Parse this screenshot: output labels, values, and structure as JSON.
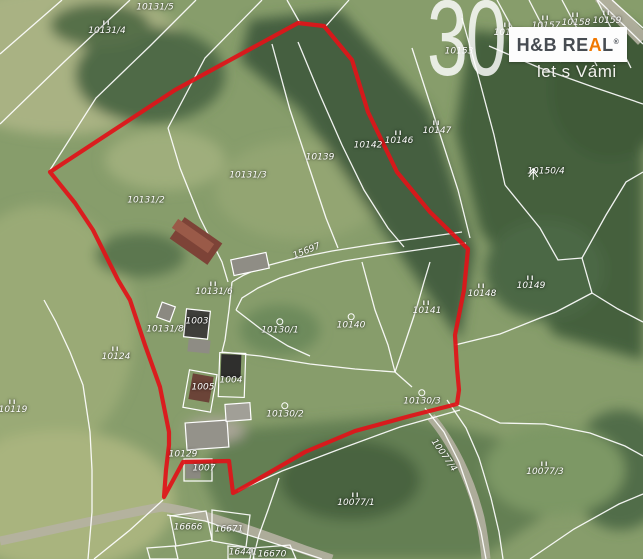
{
  "watermark": {
    "number": "30",
    "slogan": "let s Vámi"
  },
  "logo": {
    "part1": "H&B RE",
    "accent_letter": "A",
    "part2": "L",
    "registered": "®",
    "accent_color": "#f07800",
    "text_color": "#474c52"
  },
  "map": {
    "boundary_color": "#e01319",
    "line_color": "rgba(255,255,255,0.92)",
    "boundary_points": "50,172 175,90 298,23 324,26 352,60 368,112 397,172 430,212 468,249 464,290 455,335 457,368 459,390 457,404 410,416 355,431 305,452 260,478 237,491 233,493 229,461 183,462 164,497 166,470 169,445 169,432 160,387 145,345 130,300 118,280 93,230 75,203",
    "cadastral_lines": [
      "62,0 0,54",
      "130,0 64,62 0,124",
      "196,0 150,46 96,98 50,170",
      "262,0 205,58 168,128",
      "287,0 300,23",
      "326,26 349,0",
      "168,128 180,168 200,218 222,262 228,282",
      "272,44 290,110 310,170 326,218 338,248",
      "298,42 320,95 342,145 364,190 388,228 404,247",
      "412,48 436,122 458,190 470,238",
      "462,18 478,75 494,135 505,185",
      "497,0 527,55",
      "529,0 561,62",
      "562,0 597,66",
      "597,0 631,68",
      "489,46 540,68 596,88 643,104",
      "598,0 643,44",
      "612,0 643,28",
      "505,185 540,228 558,260 582,258",
      "582,258 606,215 626,182 643,172",
      "582,258 592,293",
      "592,293 556,312 540,318 500,334 455,345",
      "592,293 618,309 643,322",
      "460,410 400,427 340,449 282,471 238,491",
      "455,404 478,413 500,423 545,424 590,433 625,446 643,456",
      "425,408 444,432 459,462 472,500 481,532 486,559",
      "447,400 466,428 479,458 491,498 499,532 503,559",
      "530,559 574,529 619,504 643,494",
      "44,300 56,322 70,352 83,385 90,432 92,470 92,512 88,559",
      "163,500 130,530 94,559",
      "167,515 205,521 245,534 292,549 322,559",
      "279,478 268,510 259,535 253,559",
      "462,232 420,238 376,244 332,251 292,259 262,267 244,275 232,282",
      "466,243 424,249 382,255 344,261 310,269 280,278 258,288 242,298 236,310",
      "232,282 229,310 225,340 222,352",
      "222,352 260,356 310,364 355,369 395,372",
      "395,372 406,340 416,310 424,282 430,262",
      "395,372 412,387",
      "236,310 262,330 288,346 310,356",
      "362,262 375,310 388,345 395,372"
    ],
    "parcel_outlines": [
      "170,516 206,511 212,540 176,546",
      "212,510 250,515 246,547 212,541",
      "228,546 252,548 250,559 228,559",
      "252,548 290,545 296,559 254,559",
      "147,548 175,546 178,559 150,559"
    ],
    "buildings": [
      {
        "cx": 196,
        "cy": 241,
        "w": 46,
        "h": 26,
        "rot": 35,
        "fill": "#7d4337",
        "stroke": ""
      },
      {
        "cx": 193,
        "cy": 236,
        "w": 44,
        "h": 11,
        "rot": 35,
        "fill": "#9a5a48",
        "stroke": ""
      },
      {
        "cx": 250,
        "cy": 264,
        "w": 36,
        "h": 16,
        "rot": -12,
        "fill": "#8f8d85",
        "stroke": "#ffffff"
      },
      {
        "cx": 197,
        "cy": 324,
        "w": 24,
        "h": 28,
        "rot": 6,
        "fill": "#3f3f3b",
        "stroke": "#ffffff"
      },
      {
        "cx": 199,
        "cy": 346,
        "w": 22,
        "h": 13,
        "rot": 6,
        "fill": "#8e8c84",
        "stroke": ""
      },
      {
        "cx": 232,
        "cy": 375,
        "w": 26,
        "h": 44,
        "rot": 2,
        "fill": "none",
        "stroke": "#ffffff"
      },
      {
        "cx": 231,
        "cy": 366,
        "w": 20,
        "h": 23,
        "rot": 2,
        "fill": "#2f2f2d",
        "stroke": ""
      },
      {
        "cx": 200,
        "cy": 391,
        "w": 28,
        "h": 38,
        "rot": 10,
        "fill": "none",
        "stroke": "#ffffff"
      },
      {
        "cx": 201,
        "cy": 388,
        "w": 21,
        "h": 26,
        "rot": 10,
        "fill": "#6b4438",
        "stroke": ""
      },
      {
        "cx": 207,
        "cy": 435,
        "w": 42,
        "h": 27,
        "rot": -4,
        "fill": "#94928a",
        "stroke": "#ffffff"
      },
      {
        "cx": 238,
        "cy": 412,
        "w": 25,
        "h": 17,
        "rot": -4,
        "fill": "#a19f97",
        "stroke": "#ffffff"
      },
      {
        "cx": 198,
        "cy": 470,
        "w": 28,
        "h": 22,
        "rot": 0,
        "fill": "none",
        "stroke": "#ffffff"
      },
      {
        "cx": 193,
        "cy": 471,
        "w": 15,
        "h": 15,
        "rot": 0,
        "fill": "#8b8981",
        "stroke": ""
      },
      {
        "cx": 166,
        "cy": 312,
        "w": 14,
        "h": 16,
        "rot": 20,
        "fill": "#8b8981",
        "stroke": "#ffffff"
      }
    ],
    "parcels": [
      {
        "label": "10131/5",
        "x": 155,
        "y": 8
      },
      {
        "label": "10131/4",
        "x": 107,
        "y": 28,
        "symbol": "II"
      },
      {
        "label": "10153",
        "x": 459,
        "y": 52
      },
      {
        "label": "10156",
        "x": 508,
        "y": 30,
        "symbol": "II"
      },
      {
        "label": "10157",
        "x": 546,
        "y": 23,
        "symbol": "II"
      },
      {
        "label": "10158",
        "x": 576,
        "y": 20,
        "symbol": "II"
      },
      {
        "label": "10159",
        "x": 607,
        "y": 18,
        "symbol": "II"
      },
      {
        "label": "10139",
        "x": 320,
        "y": 158
      },
      {
        "label": "10142",
        "x": 368,
        "y": 146
      },
      {
        "label": "10146",
        "x": 399,
        "y": 138,
        "symbol": "II"
      },
      {
        "label": "10147",
        "x": 437,
        "y": 128,
        "symbol": "II"
      },
      {
        "label": "10150/4",
        "x": 546,
        "y": 172,
        "symbol": "conifer"
      },
      {
        "label": "10131/3",
        "x": 248,
        "y": 176
      },
      {
        "label": "10131/2",
        "x": 146,
        "y": 201
      },
      {
        "label": "10131/6",
        "x": 214,
        "y": 289,
        "symbol": "II"
      },
      {
        "label": "15697",
        "x": 307,
        "y": 252,
        "rot": -22
      },
      {
        "label": "10131/8",
        "x": 165,
        "y": 330
      },
      {
        "label": "10124",
        "x": 116,
        "y": 354,
        "symbol": "II"
      },
      {
        "label": "10119",
        "x": 13,
        "y": 407,
        "symbol": "II"
      },
      {
        "label": "10148",
        "x": 482,
        "y": 291,
        "symbol": "II"
      },
      {
        "label": "10149",
        "x": 531,
        "y": 283,
        "symbol": "II"
      },
      {
        "label": "10141",
        "x": 427,
        "y": 308,
        "symbol": "II"
      },
      {
        "label": "10140",
        "x": 351,
        "y": 322,
        "symbol": "circle"
      },
      {
        "label": "10130/1",
        "x": 280,
        "y": 327,
        "symbol": "circle"
      },
      {
        "label": "10130/2",
        "x": 285,
        "y": 411,
        "symbol": "circle"
      },
      {
        "label": "10130/3",
        "x": 422,
        "y": 398,
        "symbol": "circle"
      },
      {
        "label": "1003",
        "x": 197,
        "y": 322
      },
      {
        "label": "1004",
        "x": 231,
        "y": 381
      },
      {
        "label": "1005",
        "x": 203,
        "y": 388
      },
      {
        "label": "10129",
        "x": 183,
        "y": 455
      },
      {
        "label": "1007",
        "x": 204,
        "y": 469
      },
      {
        "label": "10077/4",
        "x": 443,
        "y": 456,
        "rot": 55
      },
      {
        "label": "10077/3",
        "x": 545,
        "y": 469,
        "symbol": "II"
      },
      {
        "label": "10077/1",
        "x": 356,
        "y": 500,
        "symbol": "II"
      },
      {
        "label": "16666",
        "x": 188,
        "y": 528
      },
      {
        "label": "16671",
        "x": 229,
        "y": 530
      },
      {
        "label": "16441",
        "x": 243,
        "y": 553
      },
      {
        "label": "16670",
        "x": 272,
        "y": 555
      }
    ]
  }
}
